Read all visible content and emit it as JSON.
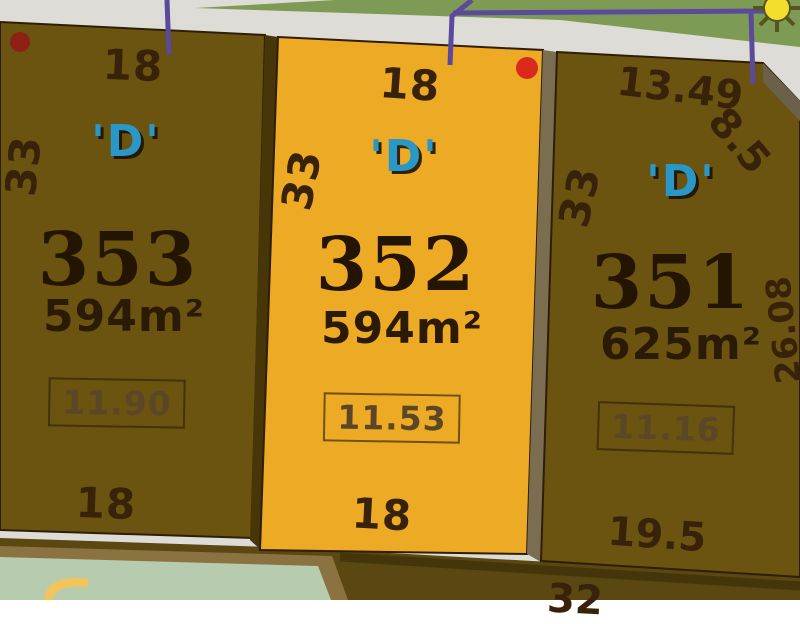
{
  "plan": {
    "lots": [
      {
        "number": "353",
        "zone": "'D'",
        "area": "594m²",
        "frontage": "11.90",
        "dim_top": "18",
        "dim_bottom": "18",
        "dim_side": "33"
      },
      {
        "number": "352",
        "zone": "'D'",
        "area": "594m²",
        "frontage": "11.53",
        "dim_top": "18",
        "dim_bottom": "18",
        "dim_side": "33"
      },
      {
        "number": "351",
        "zone": "'D'",
        "area": "625m²",
        "frontage": "11.16",
        "dim_top": "13.49",
        "dim_corner": "8.5",
        "dim_bottom": "19.5",
        "dim_side": "33",
        "dim_depth": "26.08"
      }
    ],
    "adjacent_lot": {
      "dim_top": "32"
    },
    "colors": {
      "highlight_lot": "#edaa24",
      "lot_brown": "#6b5310",
      "road": "#dedcd6",
      "grass": "#7d9b55",
      "zone_blue": "#2a98c6",
      "marker_red_bright": "#d92a1d",
      "marker_red_dark": "#8e2015",
      "utility_purple": "#5b4a9b",
      "garden_green": "#b7cbae",
      "garden_arc_yellow": "#f2c45c"
    }
  }
}
